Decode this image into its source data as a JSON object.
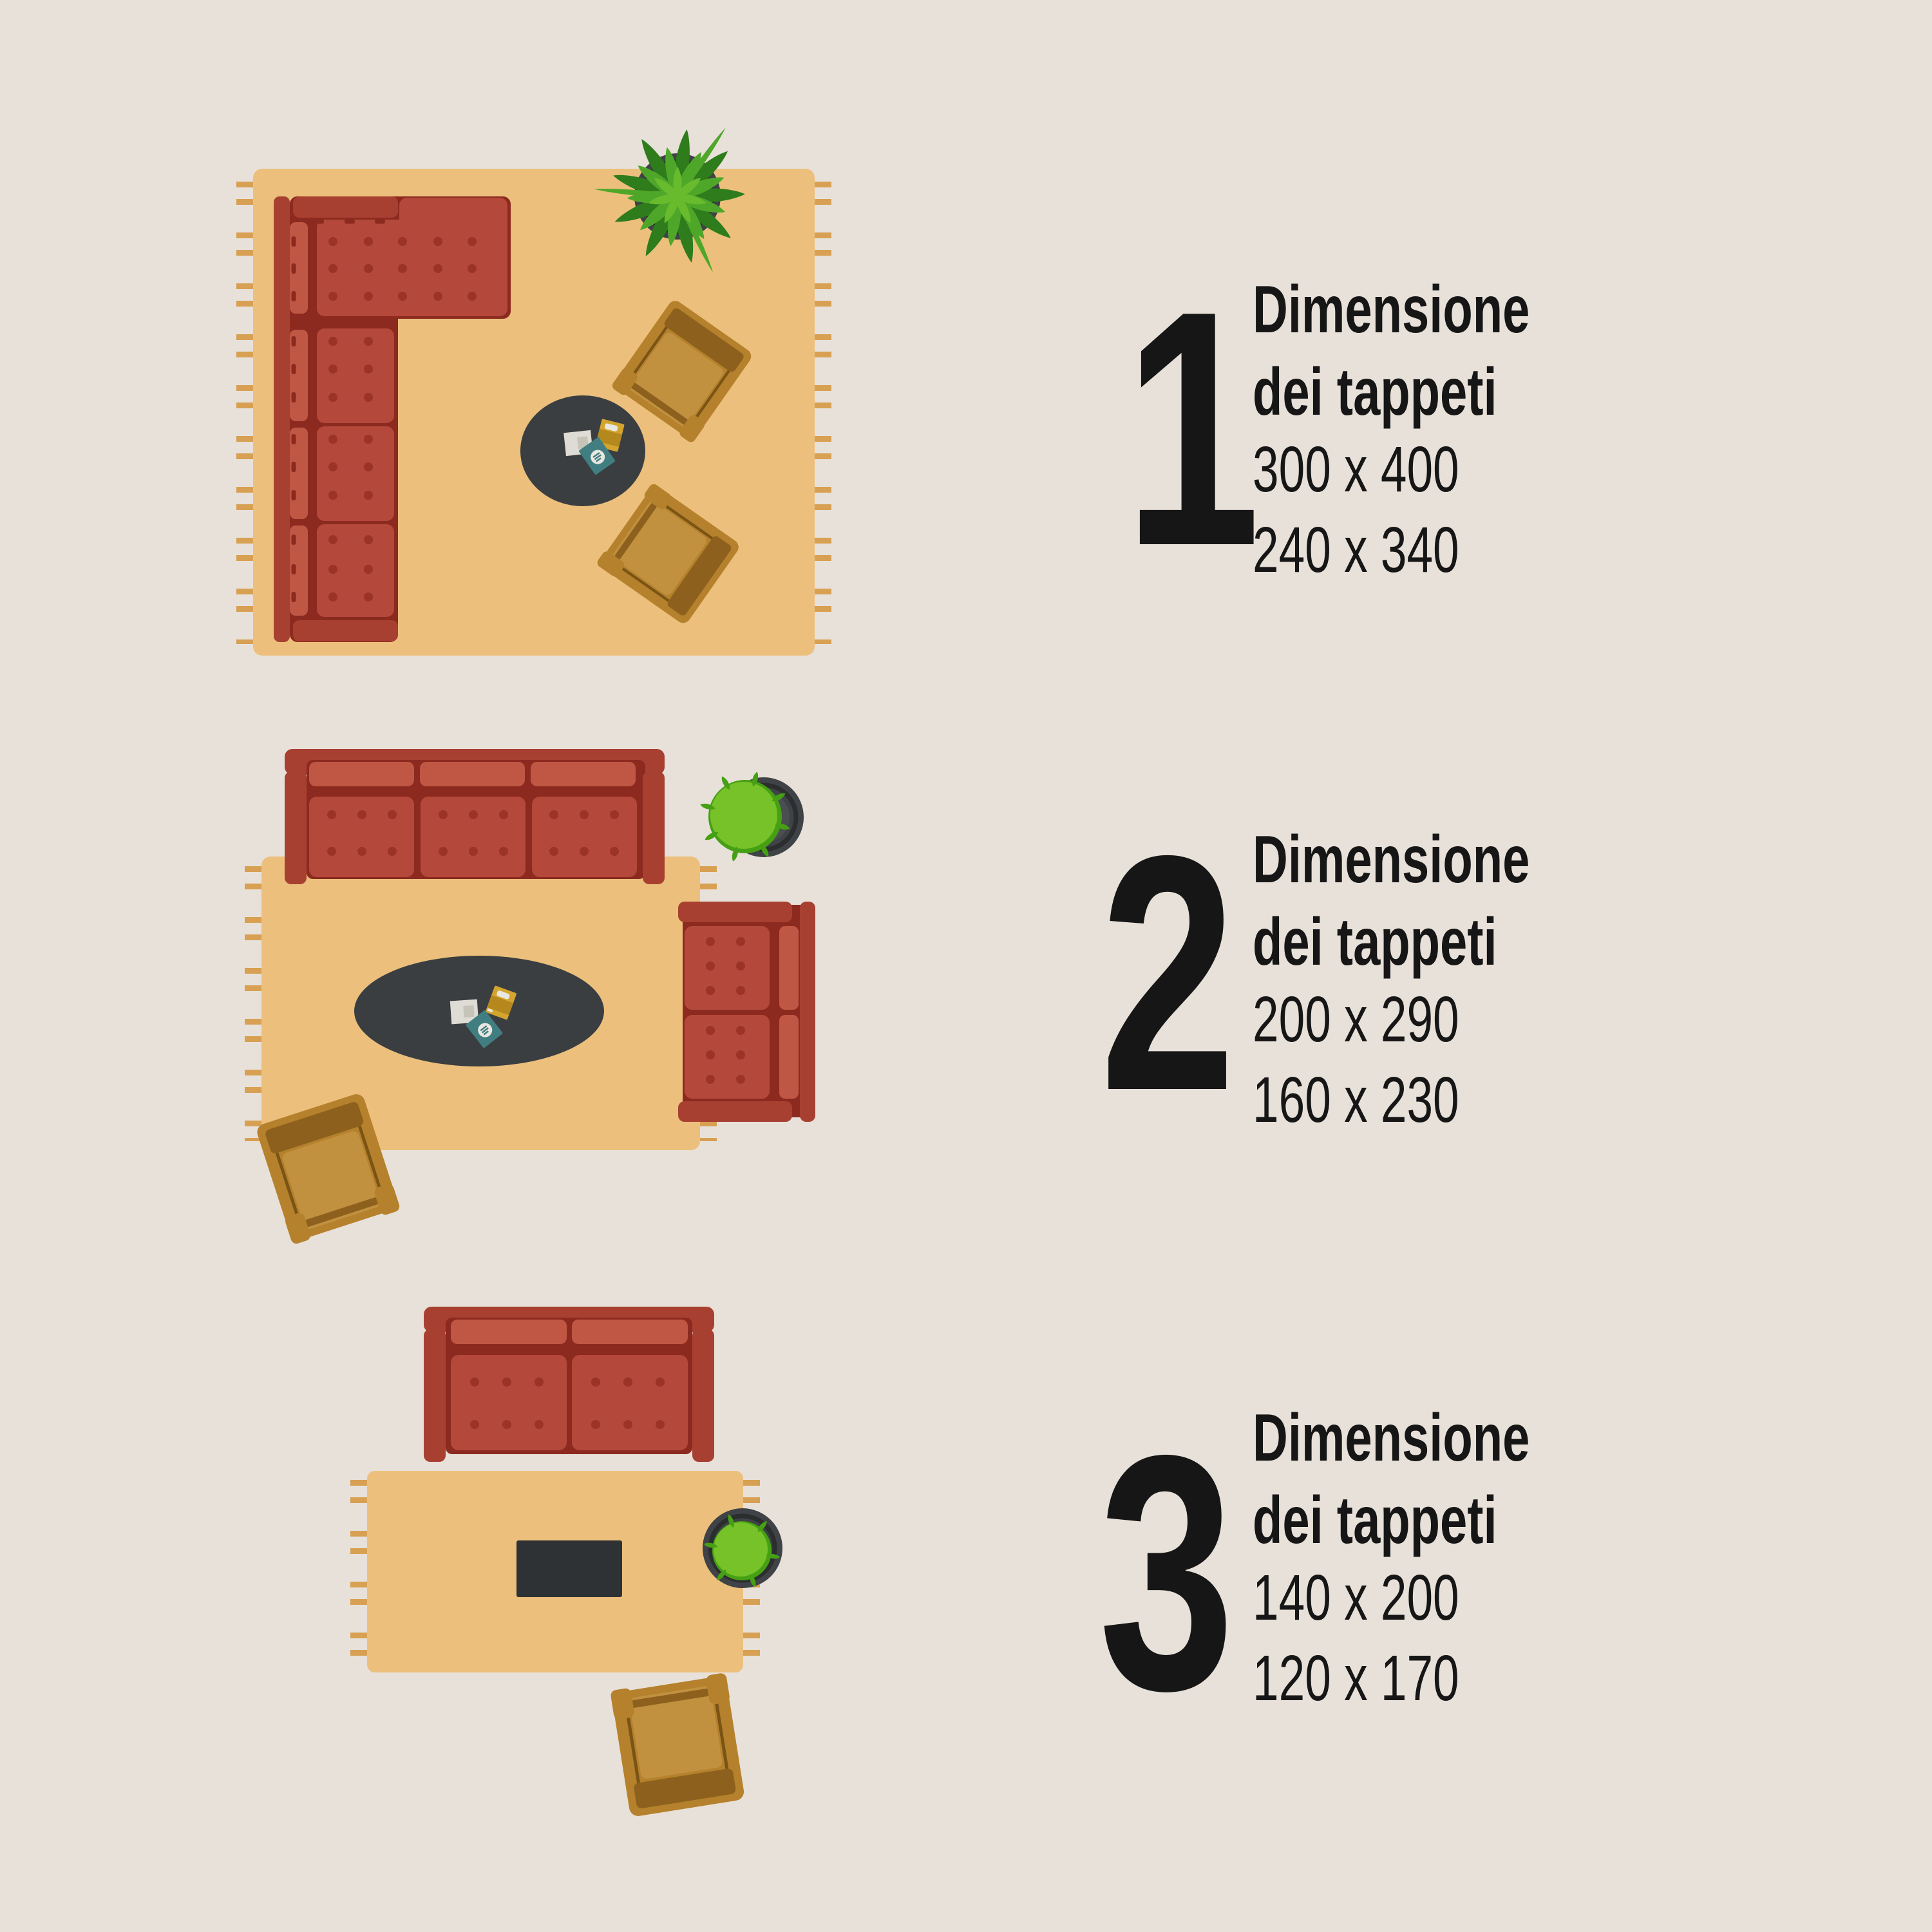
{
  "colors": {
    "bg": "#e8e1d9",
    "text": "#161616",
    "rug": "#ecc07c",
    "fringe": "#d8a052",
    "sofa_red": "#b4483a",
    "sofa_red_light": "#c05744",
    "sofa_red_frame": "#a84031",
    "sofa_red_dark": "#8c2a20",
    "sofa_dot": "#9c3327",
    "chair_body": "#b5812c",
    "chair_band": "#8d611d",
    "chair_seat": "#c19140",
    "chair_line": "#7a5415",
    "table_round": "#3a3e41",
    "table_rect": "#2f3235",
    "mag_white": "#dedcd4",
    "mag_white_inner": "#c6c3b8",
    "mag_yellow": "#d3a52f",
    "mag_yellow_dark": "#b5881e",
    "mag_teal": "#417e82",
    "mag_logo": "#e9e7e0",
    "plant_dark": "#2e7c1c",
    "plant_mid": "#4fa72a",
    "plant_light": "#68bb2d",
    "bush_green": "#77c229",
    "bush_edge": "#46a013",
    "pot": "#3f4246",
    "pot_ring": "#2b2d2f",
    "pot_inner": "#4a4e51"
  },
  "blocks": [
    {
      "number": "1",
      "title_line1": "Dimensione",
      "title_line2": "dei tappeti",
      "size_primary": "300 x 400",
      "size_secondary": "240 x 340"
    },
    {
      "number": "2",
      "title_line1": "Dimensione",
      "title_line2": "dei tappeti",
      "size_primary": "200 x 290",
      "size_secondary": "160 x 230"
    },
    {
      "number": "3",
      "title_line1": "Dimensione",
      "title_line2": "dei tappeti",
      "size_primary": "140 x 200",
      "size_secondary": "120 x 170"
    }
  ]
}
